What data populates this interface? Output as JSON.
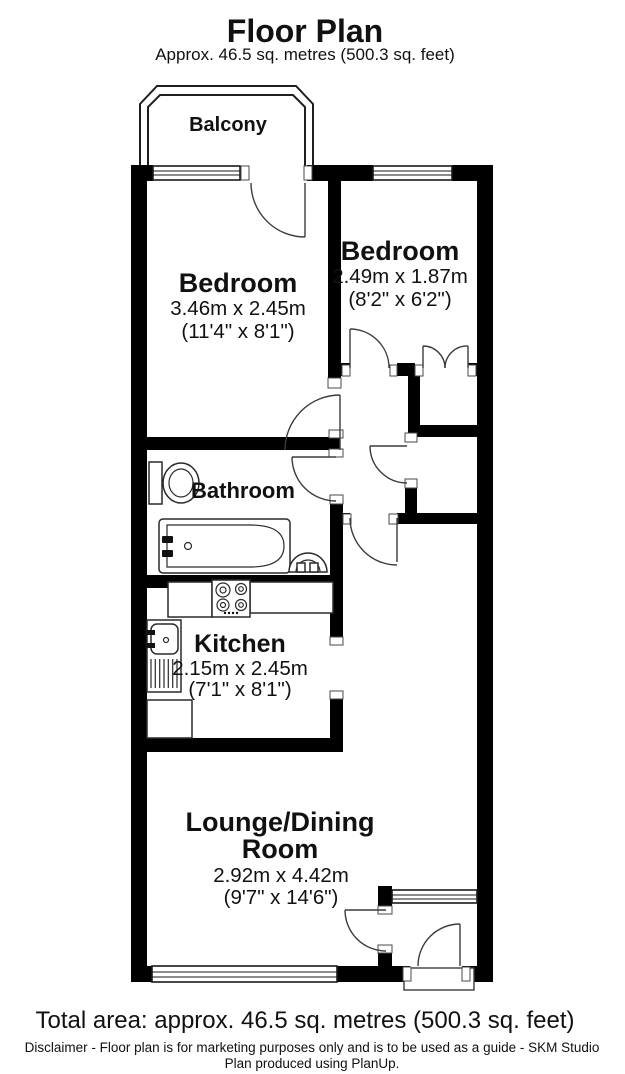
{
  "header": {
    "title": "Floor Plan",
    "subtitle": "Approx. 46.5 sq. metres (500.3 sq. feet)"
  },
  "rooms": {
    "balcony": {
      "name": "Balcony"
    },
    "bedroom1": {
      "name": "Bedroom",
      "metric": "3.46m x 2.45m",
      "imperial": "(11'4\" x 8'1\")"
    },
    "bedroom2": {
      "name": "Bedroom",
      "metric": "2.49m x 1.87m",
      "imperial": "(8'2\" x 6'2\")"
    },
    "bathroom": {
      "name": "Bathroom"
    },
    "kitchen": {
      "name": "Kitchen",
      "metric": "2.15m x 2.45m",
      "imperial": "(7'1\" x 8'1\")"
    },
    "lounge": {
      "name_line1": "Lounge/Dining",
      "name_line2": "Room",
      "metric": "2.92m x 4.42m",
      "imperial": "(9'7\" x 14'6\")"
    }
  },
  "footer": {
    "total_area": "Total area: approx. 46.5 sq. metres (500.3 sq. feet)",
    "disclaimer_line1": "Disclaimer - Floor plan is for marketing purposes only and is to be used as a guide - SKM Studio",
    "disclaimer_line2": "Plan produced using PlanUp."
  },
  "colors": {
    "wall": "#000000",
    "background": "#ffffff",
    "text": "#111111"
  }
}
